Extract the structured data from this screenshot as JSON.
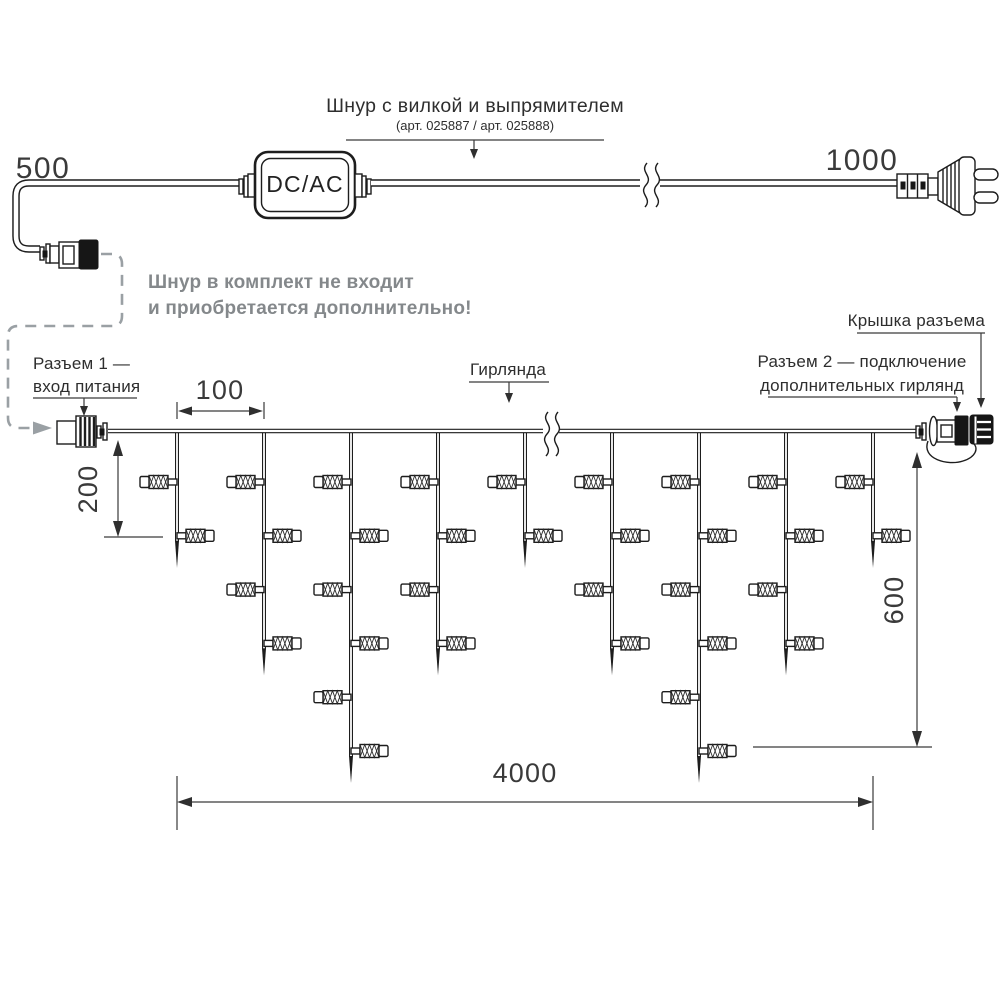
{
  "header": {
    "title": "Шнур с вилкой и выпрямителем",
    "subtitle": "(арт. 025887 / арт. 025888)"
  },
  "note": {
    "line1": "Шнур в комплект не входит",
    "line2": "и приобретается дополнительно!"
  },
  "converter": {
    "label": "DC/AC"
  },
  "dims": {
    "cord_left": "500",
    "cord_right": "1000",
    "drop_gap": "100",
    "drop_len": "200",
    "height": "600",
    "length": "4000"
  },
  "callouts": {
    "connector1_line1": "Разъем 1 —",
    "connector1_line2": "вход питания",
    "garland": "Гирлянда",
    "cap": "Крышка разъема",
    "connector2_line1": "Разъем 2 — подключение",
    "connector2_line2": "дополнительных гирлянд"
  },
  "garland": {
    "start_x": 177,
    "spacing": 87,
    "top_y": 430,
    "first_level_y": 482,
    "level_spacing": 53.8,
    "lamp_counts": [
      2,
      4,
      6,
      4,
      2,
      4,
      6,
      4,
      2
    ]
  },
  "colors": {
    "ink": "#1d1d1d",
    "dim_lines": "#3a3a3a",
    "muted_text": "#84888b",
    "dashed_gray": "#9aa0a4",
    "background": "#ffffff"
  }
}
